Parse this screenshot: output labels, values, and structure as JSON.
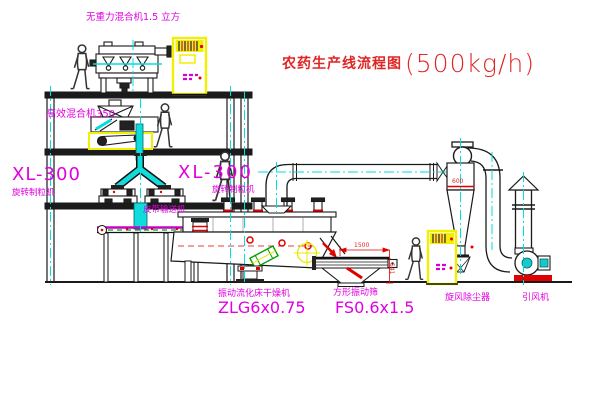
{
  "title": {
    "text_cn": "农药生产线流程图",
    "capacity": "(500kg/h)"
  },
  "equipment_labels": {
    "gravity_free_mixer": "无重力混合机1.5 立方",
    "high_speed_mixer": "高效混合机350",
    "granulator_left_model": "XL-300",
    "granulator_left_name": "旋转制粒机",
    "granulator_right_model": "XL-300",
    "granulator_right_name": "旋转制粒机",
    "belt_conveyor": "皮带输送机",
    "fluid_bed_dryer_name": "振动流化床干燥机",
    "fluid_bed_dryer_model": "ZLG6x0.75",
    "vibrating_sieve_name": "方形振动筛",
    "vibrating_sieve_model": "FS0.6x1.5",
    "cyclone_dust_collector": "旋风除尘器",
    "induced_draft_fan": "引风机"
  },
  "dimensions": {
    "cyclone_diameter": "600",
    "sieve_length": "1500",
    "sieve_height": "541"
  },
  "colors": {
    "label_magenta": "#E100E1",
    "title_red": "#E02525",
    "centerline_cyan": "#00DEDE",
    "cabinet_yellow": "#F0F000",
    "line_black": "#1A1A1A",
    "accent_green": "#00A000"
  }
}
